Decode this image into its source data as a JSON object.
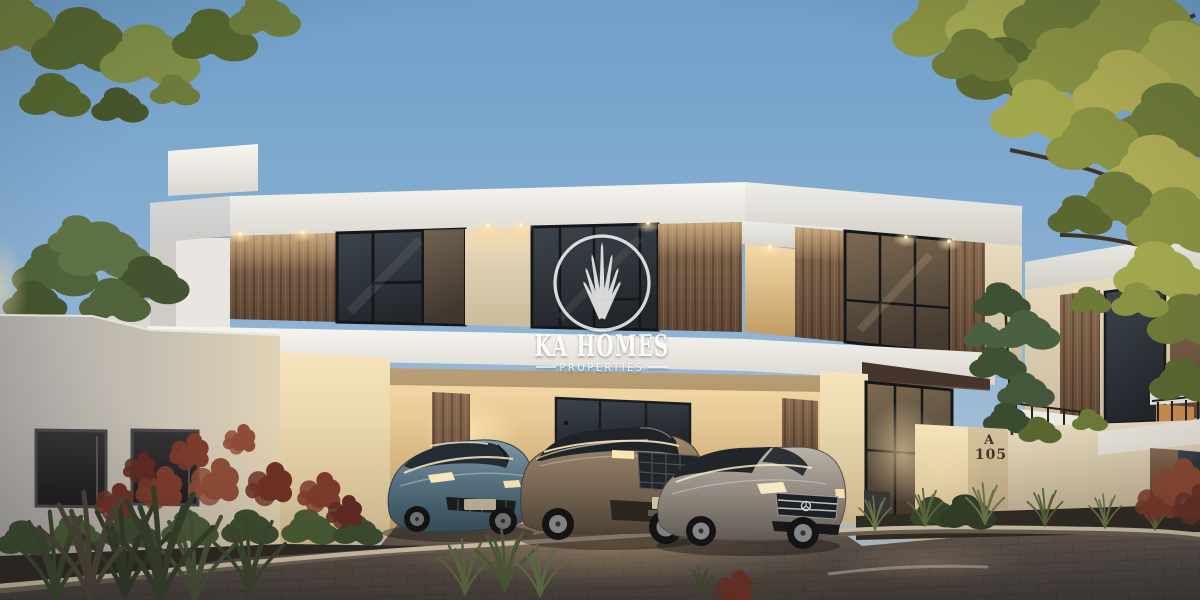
{
  "meta": {
    "type": "architectural-render",
    "scene": "modern-villa-exterior-at-dusk",
    "width": 1200,
    "height": 600
  },
  "watermark": {
    "brand": "KA HOMES",
    "tagline": "PROPERTIES",
    "logo": "skyline-circle-logo",
    "color": "#ffffff"
  },
  "signage": {
    "house_block": "A",
    "house_number": "105"
  },
  "palette": {
    "sky_top": "#6f9fc9",
    "sky_mid": "#8fb3d4",
    "sky_horizon": "#c2cfd8",
    "roof_white": "#f3f1ec",
    "wall_cream": "#e2d5b8",
    "wall_lit_warm": "#f6e2b4",
    "wood_clad": "#7c6450",
    "window_glass": "#31373d",
    "window_frame": "#17191c",
    "warm_light": "#ffdc9e",
    "pavement": "#4c4441",
    "curb_stone": "#d6c9b0",
    "foliage_green": "#55673a",
    "foliage_autumn": "#a0a34c",
    "shrub_red": "#7c392b",
    "watermark_white": "#ffffff",
    "house_number_color": "#3f362b"
  },
  "scene": {
    "time_of_day": "dusk",
    "buildings": [
      "main-villa",
      "left-neighbor-structures",
      "right-neighbor-villas"
    ],
    "vehicles": [
      {
        "name": "sports-sedan",
        "color_name": "steel-blue",
        "color": "#5f7d8e",
        "position": "left"
      },
      {
        "name": "luxury-suv",
        "color_name": "bronze",
        "color": "#8e7c66",
        "position": "center"
      },
      {
        "name": "sedan",
        "color_name": "silver",
        "color": "#a49f98",
        "position": "right"
      }
    ],
    "landscape": [
      "overhanging-branch-top-left",
      "large-tree-top-right",
      "garden-tree-left",
      "entrance-tree",
      "red-shrubs",
      "green-hedges",
      "ornamental-grasses"
    ],
    "lighting": [
      "recessed-soffit-downlights",
      "warm-interior-glow",
      "entrance-glow"
    ]
  }
}
